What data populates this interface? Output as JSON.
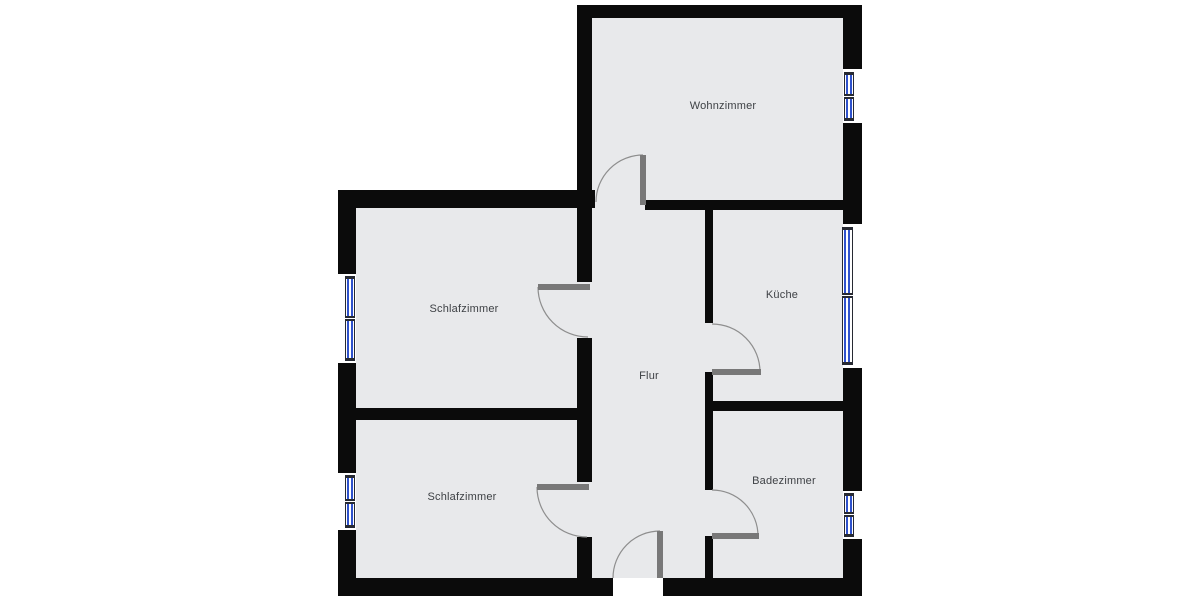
{
  "canvas": {
    "width": 1200,
    "height": 600,
    "background": "#ffffff"
  },
  "colors": {
    "floor": "#e8e9eb",
    "wall": "#0b0b0b",
    "window_glass": "#2f52cc",
    "window_frame": "#272a33",
    "door_panel": "#787878",
    "door_arc": "#8e8e8e",
    "label_text": "#3e4145"
  },
  "plan": {
    "floors": [
      {
        "name": "apartment-floor-main",
        "x": 338,
        "y": 190,
        "w": 524,
        "h": 388
      },
      {
        "name": "apartment-floor-wohnzimmer",
        "x": 577,
        "y": 5,
        "w": 285,
        "h": 205
      }
    ],
    "walls": [
      {
        "name": "outer-top",
        "x": 577,
        "y": 5,
        "w": 285,
        "h": 13
      },
      {
        "name": "wohnzimmer-left",
        "x": 577,
        "y": 5,
        "w": 15,
        "h": 191
      },
      {
        "name": "left-block-top",
        "x": 338,
        "y": 190,
        "w": 257,
        "h": 18
      },
      {
        "name": "outer-left",
        "x": 338,
        "y": 190,
        "w": 18,
        "h": 406
      },
      {
        "name": "outer-bottom-west",
        "x": 338,
        "y": 578,
        "w": 275,
        "h": 18
      },
      {
        "name": "outer-bottom-east",
        "x": 663,
        "y": 578,
        "w": 199,
        "h": 18
      },
      {
        "name": "outer-right",
        "x": 843,
        "y": 5,
        "w": 19,
        "h": 591
      },
      {
        "name": "flur-bedroom-upper",
        "x": 577,
        "y": 208,
        "w": 15,
        "h": 74
      },
      {
        "name": "flur-bedroom-middle",
        "x": 577,
        "y": 338,
        "w": 15,
        "h": 144
      },
      {
        "name": "flur-bedroom-lower",
        "x": 577,
        "y": 537,
        "w": 15,
        "h": 41
      },
      {
        "name": "bedroom-divider",
        "x": 338,
        "y": 408,
        "w": 254,
        "h": 12
      },
      {
        "name": "wohnzimmer-kueche-divider",
        "x": 645,
        "y": 200,
        "w": 200,
        "h": 10
      },
      {
        "name": "flur-kueche-upper",
        "x": 705,
        "y": 200,
        "w": 8,
        "h": 123
      },
      {
        "name": "flur-kueche-lower",
        "x": 705,
        "y": 372,
        "w": 8,
        "h": 118
      },
      {
        "name": "flur-bad-lower",
        "x": 705,
        "y": 536,
        "w": 8,
        "h": 42
      },
      {
        "name": "kueche-bad-divider",
        "x": 713,
        "y": 401,
        "w": 132,
        "h": 10
      }
    ],
    "windows": [
      {
        "name": "schlafzimmer-1-window",
        "gap": {
          "x": 338,
          "y": 274,
          "w": 18,
          "h": 89
        },
        "frame": {
          "x": 345,
          "y": 276,
          "w": 10,
          "h": 85
        }
      },
      {
        "name": "schlafzimmer-2-window",
        "gap": {
          "x": 338,
          "y": 473,
          "w": 18,
          "h": 57
        },
        "frame": {
          "x": 345,
          "y": 475,
          "w": 10,
          "h": 53
        }
      },
      {
        "name": "wohnzimmer-window",
        "gap": {
          "x": 843,
          "y": 69,
          "w": 19,
          "h": 54
        },
        "frame": {
          "x": 844,
          "y": 72,
          "w": 10,
          "h": 49
        }
      },
      {
        "name": "kueche-window",
        "gap": {
          "x": 843,
          "y": 224,
          "w": 19,
          "h": 144
        },
        "frame": {
          "x": 842,
          "y": 227,
          "w": 11,
          "h": 138
        }
      },
      {
        "name": "badezimmer-window",
        "gap": {
          "x": 843,
          "y": 491,
          "w": 19,
          "h": 48
        },
        "frame": {
          "x": 844,
          "y": 493,
          "w": 10,
          "h": 44
        }
      }
    ],
    "doors": [
      {
        "name": "wohnzimmer-door",
        "panel": {
          "x": 640,
          "y": 155,
          "w": 6,
          "h": 50
        },
        "arc": {
          "sx": 643,
          "sy": 155,
          "ex": 596,
          "ey": 202,
          "r": 47,
          "sweep": 0
        }
      },
      {
        "name": "schlafzimmer-1-door",
        "panel": {
          "x": 538,
          "y": 284,
          "w": 52,
          "h": 6
        },
        "arc": {
          "sx": 538,
          "sy": 287,
          "ex": 588,
          "ey": 337,
          "r": 50,
          "sweep": 0
        }
      },
      {
        "name": "schlafzimmer-2-door",
        "panel": {
          "x": 537,
          "y": 484,
          "w": 52,
          "h": 6
        },
        "arc": {
          "sx": 537,
          "sy": 487,
          "ex": 587,
          "ey": 537,
          "r": 50,
          "sweep": 0
        }
      },
      {
        "name": "kueche-door",
        "panel": {
          "x": 712,
          "y": 369,
          "w": 49,
          "h": 6
        },
        "arc": {
          "sx": 712,
          "sy": 324,
          "ex": 760,
          "ey": 372,
          "r": 48,
          "sweep": 1
        }
      },
      {
        "name": "badezimmer-door",
        "panel": {
          "x": 712,
          "y": 533,
          "w": 47,
          "h": 6
        },
        "arc": {
          "sx": 712,
          "sy": 490,
          "ex": 758,
          "ey": 536,
          "r": 46,
          "sweep": 1
        }
      },
      {
        "name": "entrance-door",
        "panel": {
          "x": 657,
          "y": 531,
          "w": 6,
          "h": 47
        },
        "arc": {
          "sx": 660,
          "sy": 531,
          "ex": 613,
          "ey": 578,
          "r": 47,
          "sweep": 0
        }
      }
    ],
    "labels": [
      {
        "name": "wohnzimmer",
        "text": "Wohnzimmer",
        "x": 723,
        "y": 106
      },
      {
        "name": "schlafzimmer-1",
        "text": "Schlafzimmer",
        "x": 464,
        "y": 309
      },
      {
        "name": "kueche",
        "text": "Küche",
        "x": 782,
        "y": 295
      },
      {
        "name": "flur",
        "text": "Flur",
        "x": 649,
        "y": 376
      },
      {
        "name": "schlafzimmer-2",
        "text": "Schlafzimmer",
        "x": 462,
        "y": 497
      },
      {
        "name": "badezimmer",
        "text": "Badezimmer",
        "x": 784,
        "y": 481
      }
    ]
  }
}
